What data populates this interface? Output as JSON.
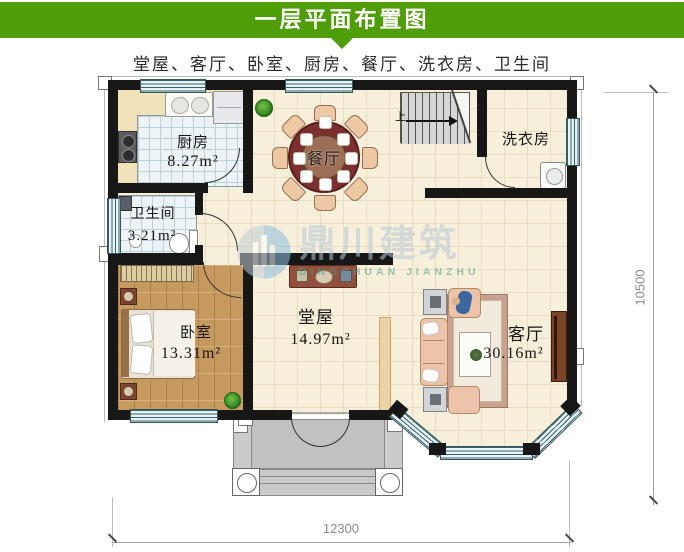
{
  "header": {
    "title": "一层平面布置图",
    "subtitle": "堂屋、客厅、卧室、厨房、餐厅、洗衣房、卫生间"
  },
  "rooms": {
    "kitchen": {
      "name": "厨房",
      "area": "8.27m²"
    },
    "bathroom": {
      "name": "卫生间",
      "area": "3.21m²"
    },
    "bedroom": {
      "name": "卧室",
      "area": "13.31m²"
    },
    "hall": {
      "name": "堂屋",
      "area": "14.97m²"
    },
    "living": {
      "name": "客厅",
      "area": "30.16m²"
    },
    "dining": {
      "name": "餐厅"
    },
    "laundry": {
      "name": "洗衣房"
    }
  },
  "stairs": {
    "up_label": "上"
  },
  "dimensions": {
    "width_mm": "12300",
    "height_mm": "10500"
  },
  "watermark": {
    "name": "鼎川建筑",
    "latin": "DINGCHUAN JIANZHU"
  },
  "colors": {
    "header_green": "#4f9d08",
    "wall": "#171717",
    "floor_cream": "#f6efd9",
    "tile_blue": "#eef3f5",
    "window_teal": "#e5f3f4",
    "wood": "#c69a5f",
    "table_maroon": "#7c2f2f",
    "sofa": "#ecc3a8",
    "porch_gray": "#cbcbcb",
    "watermark_blue": "#b5c8d6",
    "watermark_teal": "#4d9f8f",
    "dim_gray": "#8b8b8b"
  }
}
